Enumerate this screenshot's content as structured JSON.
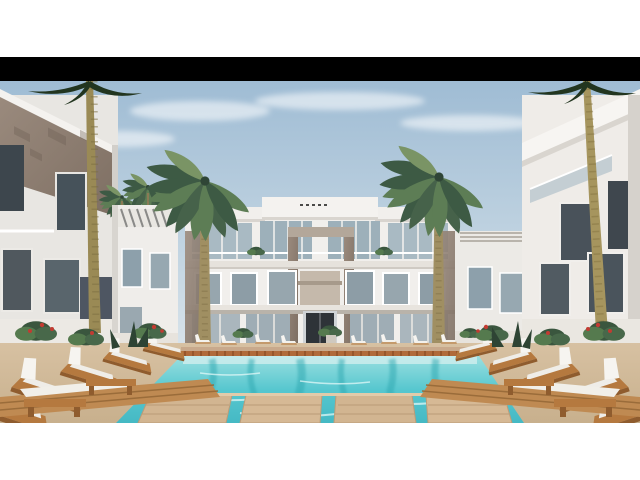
{
  "image": {
    "kind": "architectural-render",
    "description": "3D rendering of a modern white resort apartment complex with a central three-storey building, flanking wings, tall palm trees, a turquoise swimming pool with timber deck platforms, and rows of white sun loungers on a sandy pool deck.",
    "objects": [
      "central-apartment-building",
      "left-wing-building",
      "right-wing-building",
      "swimming-pool",
      "timber-deck-platforms",
      "sun-loungers",
      "palm-trees",
      "flowering-planters",
      "striped-pergola"
    ]
  },
  "palette": {
    "letterbox": "#000000",
    "page_background": "#ffffff",
    "sky_top": "#9fbcd4",
    "sky_mid": "#c6d7e3",
    "sky_bottom": "#e9eef1",
    "building_white": "#f1efec",
    "building_shadow": "#d6d2cc",
    "stone_cladding": "#9a8a7d",
    "stone_dark": "#7e6f63",
    "glass": "#a9bac3",
    "window_dark": "#49525a",
    "door_dark": "#2e3338",
    "water_top": "#9adfe0",
    "water_mid": "#57c7cf",
    "water_deep": "#45b9c4",
    "water_ledge": "#cfeeee",
    "sand": "#d7c1a2",
    "sand_dark": "#c8b08d",
    "wood": "#b5793f",
    "wood_dark": "#8f5c2e",
    "plank": "#d2b591",
    "terracotta": "#b06a3a",
    "cushion": "#f4f2ee",
    "palm_dark": "#3d5a44",
    "palm_mid": "#5d7d55",
    "palm_light": "#7a9465",
    "trunk": "#a08f62",
    "flower_red": "#c23b32"
  }
}
